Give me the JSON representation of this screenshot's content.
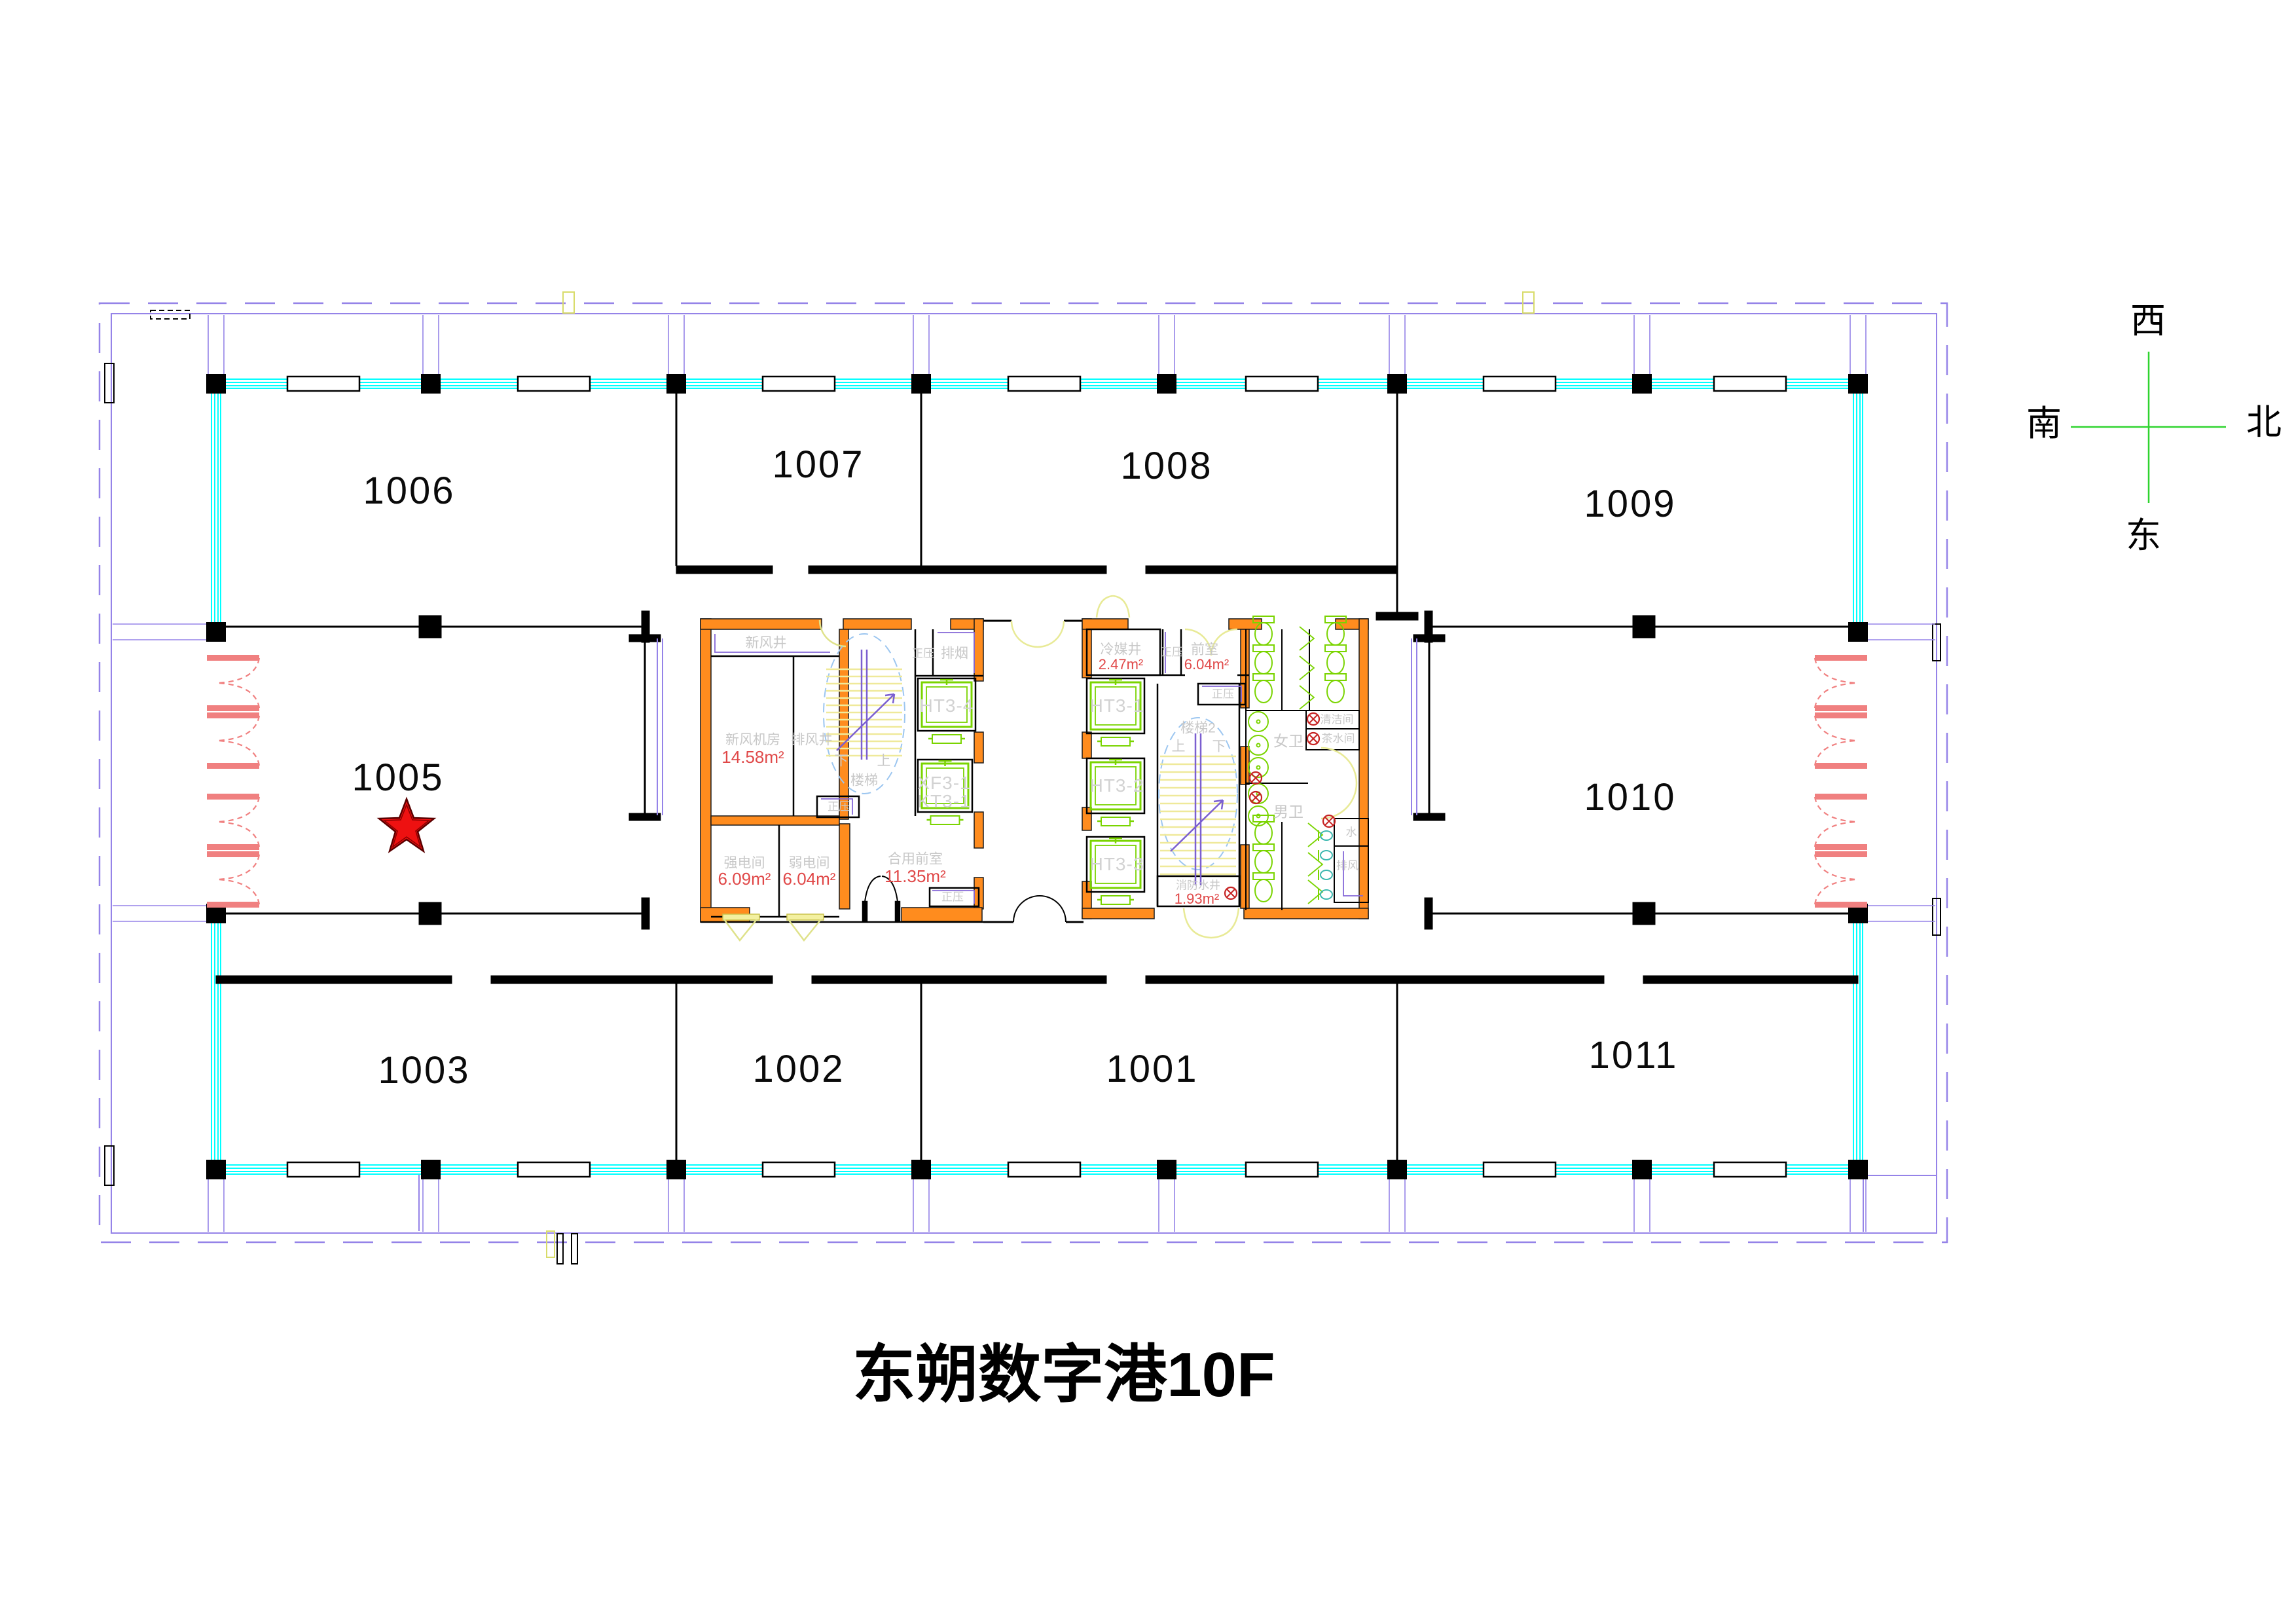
{
  "title": "东朔数字港10F",
  "compass": {
    "west": "西",
    "south": "南",
    "north": "北",
    "east": "东"
  },
  "rooms": {
    "n1001": "1001",
    "n1002": "1002",
    "n1003": "1003",
    "n1005": "1005",
    "n1006": "1006",
    "n1007": "1007",
    "n1008": "1008",
    "n1009": "1009",
    "n1010": "1010",
    "n1011": "1011"
  },
  "core_west": {
    "fresh_air_shaft": "新风井",
    "fresh_air_plant_room": "新风机房",
    "fresh_air_plant_room_area": "14.58m²",
    "exhaust_air_shaft": "排风井",
    "positive_pressure_top": "正压",
    "smoke_exhaust": "排烟",
    "elevator_ht3_4": "HT3-4",
    "elevator_xf3_1": "XF3-1",
    "elevator_kt3_1": "KT3-1",
    "stair": "楼梯",
    "stair_up": "上",
    "stair_down": "下",
    "positive_pressure_mid": "正压",
    "strong_electric_room": "强电间",
    "strong_electric_room_area": "6.09m²",
    "weak_electric_room": "弱电间",
    "weak_electric_room_area": "6.04m²",
    "shared_front_room": "合用前室",
    "shared_front_room_area": "11.35m²",
    "positive_pressure_bottom": "正压"
  },
  "core_east": {
    "refrigerant_shaft": "冷媒井",
    "refrigerant_shaft_area": "2.47m²",
    "positive_pressure_top": "正压",
    "front_room": "前室",
    "front_room_area": "6.04m²",
    "positive_pressure_mid": "正压",
    "elevator_ht3_1": "HT3-1",
    "elevator_ht3_2": "HT3-2",
    "elevator_ht3_3": "HT3-3",
    "stair2": "楼梯2",
    "stair_up": "上",
    "stair_down": "下",
    "womens_wc": "女卫",
    "mens_wc": "男卫",
    "cleaning_room": "清洁间",
    "tea_room": "茶水间",
    "water_room": "水",
    "exhaust_room": "排风",
    "fire_water_shaft": "消防水井",
    "fire_water_shaft_area": "1.93m²"
  },
  "colors": {
    "boundary": "#9583e8",
    "curtain_wall": "#00ffff",
    "core_wall": "#ff8c1e",
    "fixtures": "#7ad400",
    "door_swing": "#f08080",
    "stair_tread": "#efe99a",
    "pale_door": "#e8ea96",
    "stair_rail": "#7b5fd0",
    "stair_ellipse": "#9cc6f0",
    "area_text": "#e04848",
    "marker_star": "#ee1111",
    "compass_line": "#2fd42f"
  }
}
